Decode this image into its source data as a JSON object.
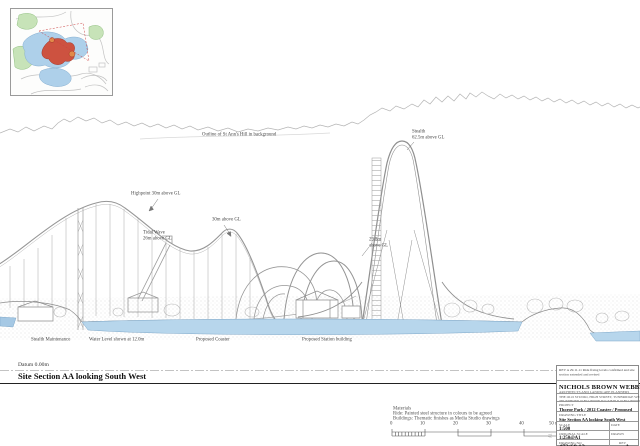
{
  "page": {
    "datum_label": "Datum 0.00m",
    "section_title": "Site Section AA looking South West"
  },
  "annotations": {
    "hill_outline": "Outline of St Ann's Hill in background",
    "highpoint": "Highpoint 30m above GL",
    "hump_height": "30m above GL",
    "tidal_wave_1": "Tidal Wave",
    "tidal_wave_2": "26m above GL",
    "stealth_1": "Stealth",
    "stealth_2": "62.5m above GL",
    "arch_1": "29.8m",
    "arch_2": "above GL",
    "stealth_maintenance": "Stealth Maintenance",
    "water_level": "Water Level shown at 12.0m",
    "proposed_coaster": "Proposed Coaster",
    "proposed_station": "Proposed Station building"
  },
  "notes": {
    "title": "Materials",
    "line1": "Ride: Painted steel structure in colours to be agreed",
    "line2": "Buildings: Thematic finishes as Media Studio drawings"
  },
  "scale_bar": {
    "ticks": [
      "0",
      "10",
      "20",
      "30",
      "40",
      "50 m"
    ]
  },
  "title_block": {
    "revision_note": "REV A  29.11.11  Ride fixing levels confirmed and site section extended and revised",
    "firm_name": "NICHOLS BROWN WEBBER",
    "firm_subtitle": "ARCHITECTS AND LANDSCAPE PLANNERS",
    "address_line1": "THE OLD STUDIO, HIGH STREET, TUNBRIDGE WELLS, KENT",
    "address_line2": "TELEPHONE 01892 000000   FACSIMILE 01892 000000",
    "project_label": "PROJECT",
    "project": "Thorpe Park / 2012 Coaster / Proposed",
    "drawing_title_label": "DRAWING TITLE",
    "drawing_title": "Site Section AA looking South West",
    "scale_label": "SCALE",
    "scale": "1:500",
    "date_label": "DATE",
    "date": "",
    "original_scale_label": "ORIGINAL SCALE",
    "original_scale": "1:250@A1",
    "drawn_label": "DRAWN",
    "drawn": "",
    "drawing_no_label": "DRAWING NO",
    "drawing_no": "472/68 12",
    "revision_label": "REV",
    "revision": "A",
    "sheet_size": "A1"
  },
  "colors": {
    "water": "#b7d6ec",
    "line_grey": "#969696",
    "green_area": "#c7e3b8",
    "ride_area_red": "#cd5240"
  }
}
